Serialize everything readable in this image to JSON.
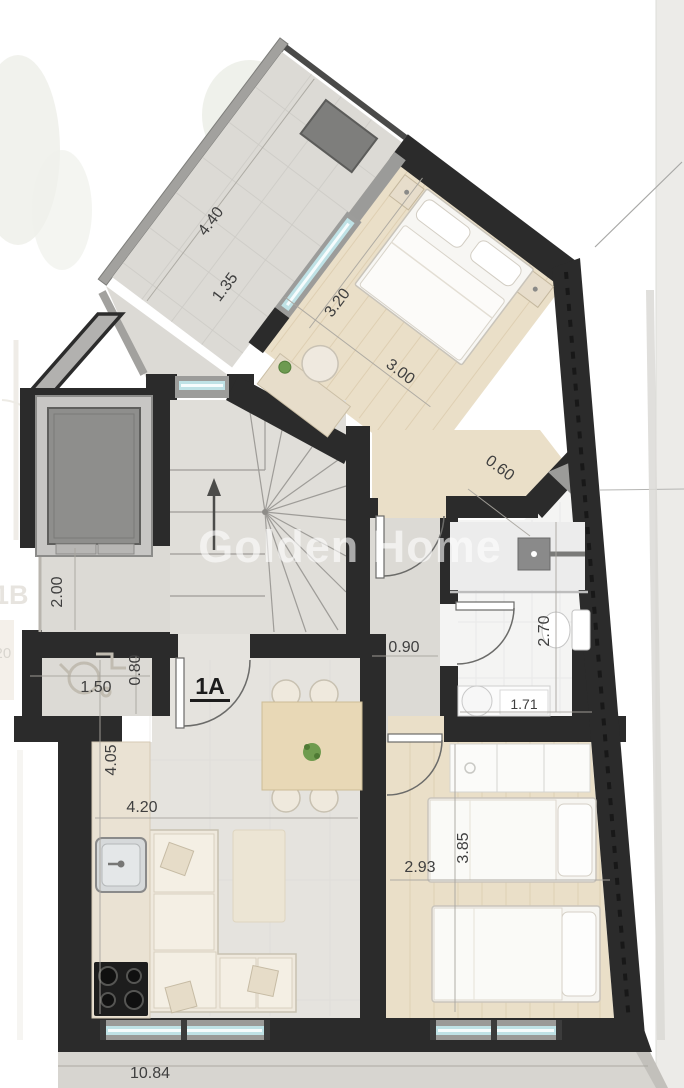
{
  "watermark": {
    "text": "Golden Home"
  },
  "unit": {
    "label": "1A"
  },
  "adjacent": {
    "unit_label": "1B",
    "dimension": "1.20"
  },
  "dimensions": {
    "terrace_length": "4.40",
    "terrace_end_width": "1.35",
    "bedroom1_width": "3.20",
    "bedroom1_length": "3.00",
    "corner_offset": "0.60",
    "corridor_depth": "2.00",
    "vestibule_width": "1.50",
    "vestibule_depth": "0.80",
    "hallway_width": "0.90",
    "bathroom_length": "2.70",
    "bathroom_width": "1.71",
    "living_depth": "4.05",
    "living_width": "4.20",
    "bedroom2_width": "2.93",
    "bedroom2_length": "3.85",
    "building_width": "10.84"
  },
  "colors": {
    "wall": "#2b2b2b",
    "window_glass": "#bfe2e6",
    "wood_floor": "#eadfc8",
    "tile_floor": "#dcdad5",
    "furniture_cream": "#efe9dd",
    "watermark": "#ffffff",
    "dimension_text": "#3f3f3f",
    "exterior_gray": "#9b9b99"
  }
}
